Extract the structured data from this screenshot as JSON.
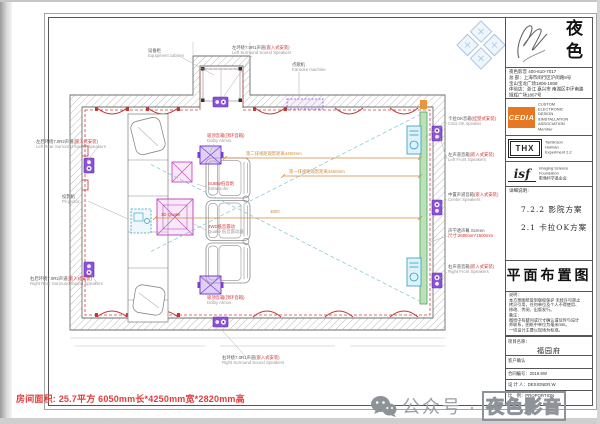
{
  "overlay": {
    "room_info": "房间面积: 25.7平方  6050mm长*4250mm宽*2820mm高",
    "wechat": {
      "account": "公众号",
      "dot": "·",
      "name": "夜色影音"
    }
  },
  "titleblock": {
    "brand_char_1": "夜",
    "brand_char_2": "色",
    "contact_lines": [
      "夜色影音 400-610-7017",
      "总 部：上海市闵行区沪闵路8号",
      "宝山宝龙广场1806-1808",
      "体验店：浙江 嘉兴市 南湖区中环南路",
      "旭辉广场1807号"
    ],
    "cedia": {
      "logo": "CEDIA",
      "line1": "CUSTOM ELECTRONIC",
      "line2": "DESIGN &INSTALLATION",
      "line3": "ASSOCIATION",
      "line4": "Member"
    },
    "thx": {
      "logo": "THX",
      "line1": "Tomlinson",
      "line2": "Holman",
      "line3": "Experiment 2.2"
    },
    "isf": {
      "logo": "isf",
      "line1": "Imaging Science",
      "line2": "Foundation",
      "line3": "影像科学基金会"
    },
    "detail_title": "详细说明：",
    "scheme_1": "7.2.2 影院方案",
    "scheme_2": "2.1 卡拉OK方案",
    "drawing_title": "平面布置图",
    "note_lines": [
      "说明：",
      "本方案图纸受到版权保护 未经许可禁止",
      "拷贝引用，任何单位及个人不得使用、",
      "修改、传阅、出版发行。",
      "备注：",
      "图纸中有疑问或尺寸确认请及时与设计",
      "师联系，图纸中单位为毫米mm。",
      "一切设计主要以现场为标准。"
    ],
    "table": {
      "project_label": "项目名称：",
      "project_value": "福园府",
      "confirm_label": "客户确认",
      "contract_label": "合同编号：2019.9W",
      "designer_label": "设 计 人：DESIGNER.W",
      "scale_label": "比　例：PROPORTION"
    }
  },
  "plan": {
    "labels": {
      "equipment_cabinet": {
        "zh": "设备柜",
        "en": "Equipment cabinet"
      },
      "left_surround": {
        "zh": "左环绕7.0R1声道",
        "red": "(嵌入式安装)",
        "en": "Left Surround Sound Speakers"
      },
      "karaoke_machine": {
        "zh": "点歌机",
        "en": "Karaoke machine"
      },
      "karaoke_speaker": {
        "zh": "卡拉OK音箱",
        "red": "(挂壁式安装)",
        "en": "Cara OK speaker"
      },
      "left_front": {
        "zh": "左声道音箱",
        "red": "(嵌入式安装)",
        "en": "Left Front Speakers"
      },
      "center_speaker": {
        "zh": "中置声道音箱",
        "red": "(嵌入式安装)",
        "en": "Center Speakers"
      },
      "screen": {
        "zh": "声学透声幕",
        "en": "Screen",
        "red2": "尺寸:2680mm*1500mm"
      },
      "right_front": {
        "zh": "右声道音箱",
        "red": "(嵌入式安装)",
        "en": "Right Front Speakers"
      },
      "left_rear": {
        "zh": "左后环绕7.0R2声道",
        "red": "(嵌入式安装)",
        "en": "Left Rear Surround Sound Speakers"
      },
      "projector": {
        "zh": "投影机",
        "en": "Projector"
      },
      "right_rear": {
        "zh": "右后环绕7.0R2声道",
        "red": "(嵌入式安装)",
        "en": "Right Rear Surround Sound Speakers"
      },
      "right_surround": {
        "zh": "右环绕7.0R1声道",
        "red": "(嵌入式安装)",
        "en": "Right Surround Sound Speakers"
      },
      "atmos_top": {
        "red": "吸顶音箱(顶环音箱)",
        "en": "Dolby Atmos"
      },
      "subwoofer": {
        "red": "SUBW低音炮",
        "en": "Subwoofer"
      },
      "quake": {
        "red": "4WD低音震动",
        "en": "Quake 低音震动器"
      },
      "quake_box": {
        "red": "3D Quake"
      },
      "atmos_bottom": {
        "red": "吸顶音箱(顶环音箱)",
        "en": "Dolby Atmos"
      }
    },
    "dims": {
      "row2": "第二排视距观影距离4450mm",
      "row1": "第一排视距观影距离3450mm",
      "total": "4800"
    }
  }
}
